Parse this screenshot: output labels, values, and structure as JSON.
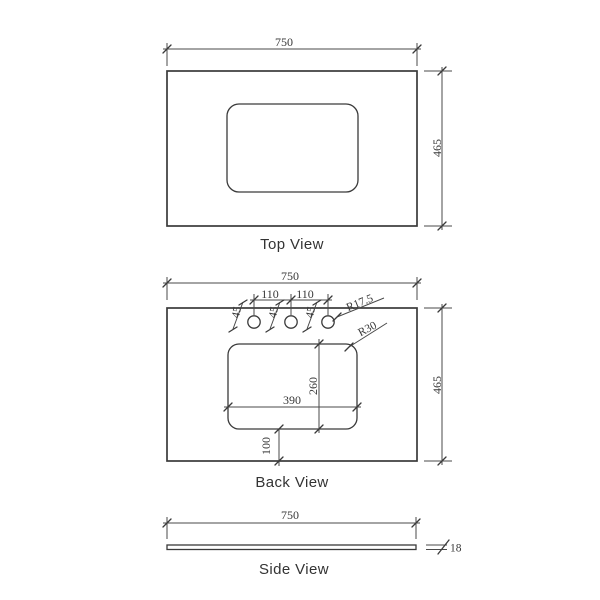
{
  "meta": {
    "background_color": "#ffffff",
    "line_color": "#3a3a3a",
    "text_color": "#383838"
  },
  "views": {
    "top": {
      "label": "Top View",
      "dims": {
        "width": "750",
        "depth": "465"
      }
    },
    "back": {
      "label": "Back View",
      "dims": {
        "width": "750",
        "depth": "465",
        "hole_spacing_left": "110",
        "hole_spacing_right": "110",
        "hole_offset_1": "45",
        "hole_offset_2": "45",
        "hole_offset_3": "45",
        "hole_radius": "R17.5",
        "cutout_corner_radius": "R30",
        "cutout_width": "390",
        "cutout_depth": "260",
        "cutout_bottom_offset": "100"
      }
    },
    "side": {
      "label": "Side View",
      "dims": {
        "width": "750",
        "thickness": "18"
      }
    }
  }
}
